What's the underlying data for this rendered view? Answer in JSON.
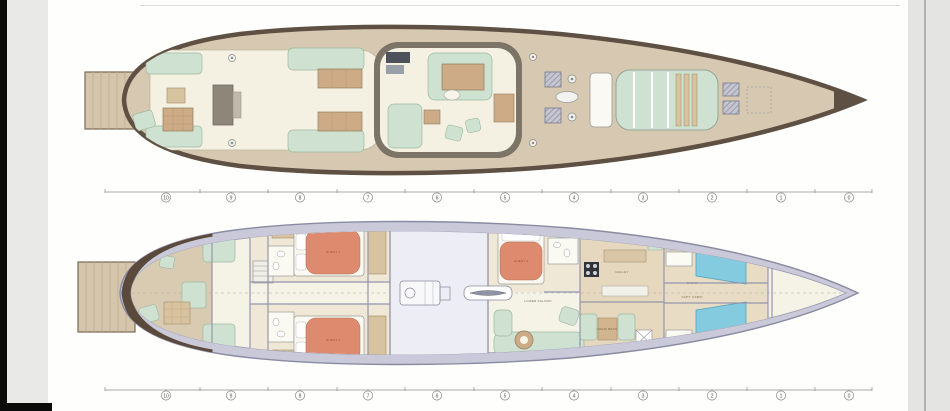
{
  "stations": {
    "labels": [
      "10",
      "9",
      "8",
      "7",
      "6",
      "5",
      "4",
      "3",
      "2",
      "1",
      "0"
    ]
  },
  "rooms": {
    "galley": "GALLEY",
    "crew_mess": "CREW MESS",
    "lower_saloon": "LOWER SALOON",
    "guest1": "GUEST 1",
    "guest2": "GUEST 2",
    "guest3": "GUEST 3",
    "cabin": "CABIN",
    "capt_cabin": "CAPT. CABIN"
  },
  "colors": {
    "deck_teak": "#d7c9b1",
    "caprail_brown": "#5e5042",
    "cockpit_cream": "#f4f1e3",
    "upholstery_mint": "#cfe2d2",
    "table_wood": "#cdab87",
    "bed_salmon": "#de8a6e",
    "lower_band_lavender": "#c9c9da",
    "engine_room": "#ededf6",
    "berth_teal": "#84cbe0",
    "station_line": "#8c8c8c",
    "scan_strip": "#e7e7e6",
    "edge_black": "#0b0b0b"
  }
}
